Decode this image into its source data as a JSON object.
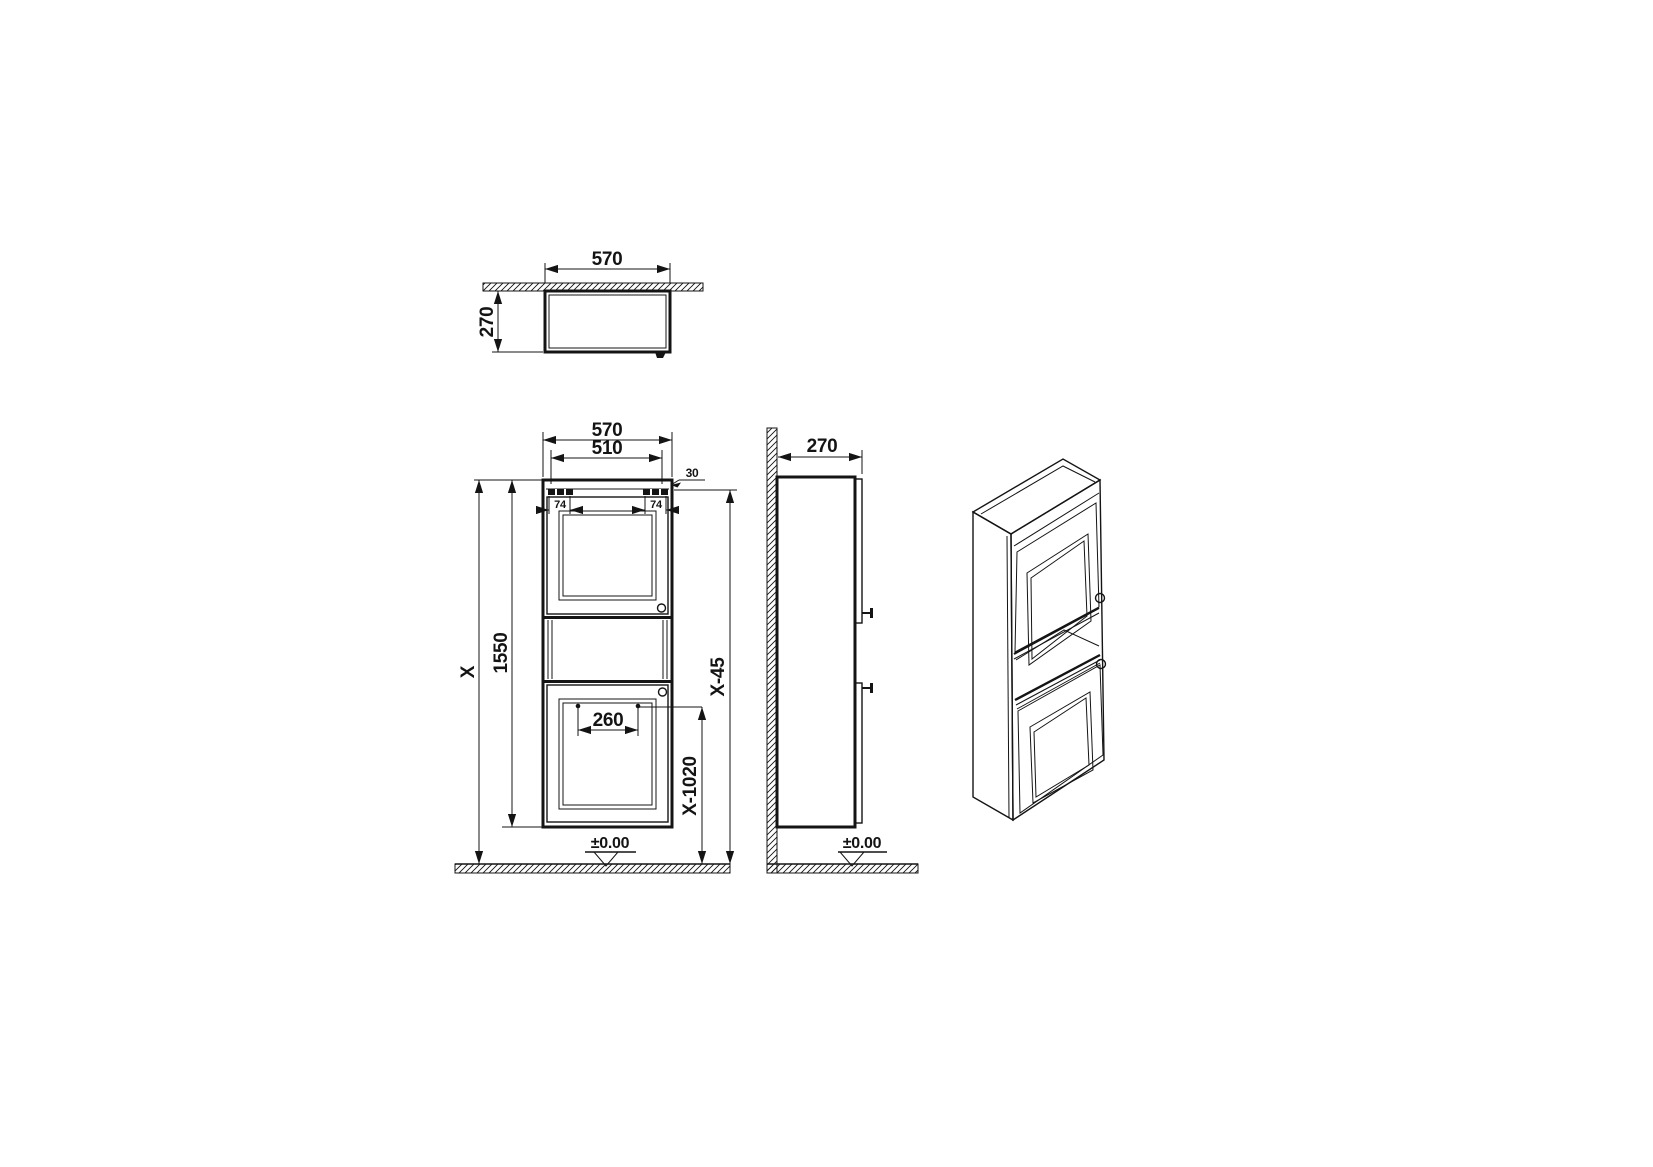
{
  "drawing": {
    "type": "technical-dimension-drawing",
    "subject": "wall-hung two-door tall cabinet",
    "datum_level": "±0.00"
  },
  "views": {
    "top": {
      "width_label": "570",
      "depth_label": "270"
    },
    "front": {
      "width_label": "570",
      "inner_width_label": "510",
      "top_offset_label": "30",
      "bracket_left_label": "74",
      "bracket_right_label": "74",
      "cabinet_height_label": "1550",
      "total_height_label": "X",
      "handle_spacing_label": "260",
      "handle_height_label": "X-1020",
      "upper_ref_label": "X-45",
      "datum_label": "±0.00"
    },
    "side": {
      "depth_label": "270",
      "datum_label": "±0.00"
    }
  }
}
